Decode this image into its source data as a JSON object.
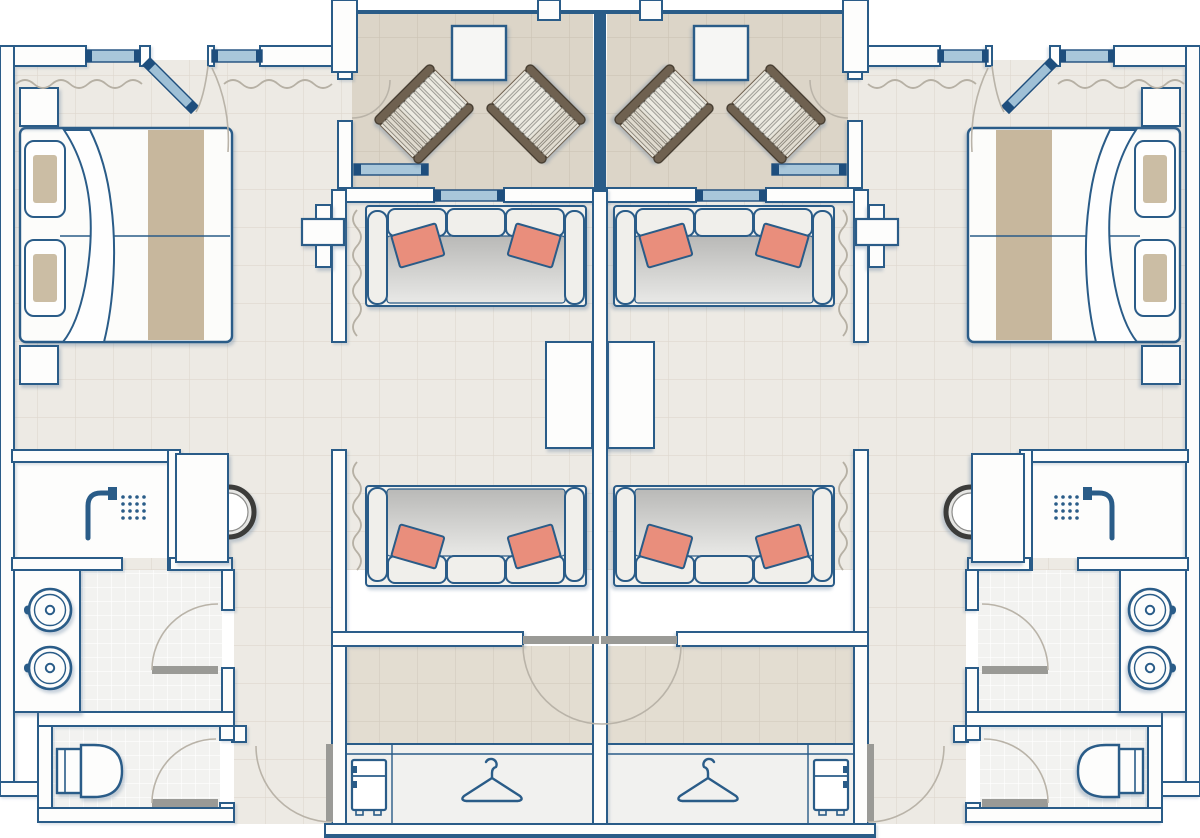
{
  "document": {
    "kind": "architectural-floor-plan",
    "title": "Twin hotel suites floor plan",
    "units": 2,
    "symmetry": "mirrored about vertical center axis",
    "visible_text": ""
  },
  "palette": {
    "wall_outline": "#2a5c88",
    "wall_fill": "#fdfdfc",
    "floor_main": "#edeae4",
    "floor_main_grid": "#ded8cf",
    "floor_balcony": "#dcd5c8",
    "floor_balcony_grid": "#ccc4b4",
    "floor_hall": "#e3ddd1",
    "floor_hall_grid": "#d3ccbe",
    "floor_tile": "#f2f2f0",
    "floor_tile_grid": "#ffffff",
    "glass": "#a9c7da",
    "glass_frame": "#1e4e7d",
    "accent_coral": "#e98e7c",
    "bed_runner": "#c7b79d",
    "pillow_inner": "#cbbda4",
    "seat_dark": "#b9b9b7",
    "seat_light": "#e9e9e7",
    "wood_dark": "#6f6150",
    "wood_edge": "#3e3529",
    "slat_light": "#edebe2",
    "slat_shade": "#e0dbcf",
    "door_leaf_gray": "#9a9a96",
    "swing_arc": "#b9b3a8",
    "railing": "#2a5c88",
    "shadow": "rgba(88,118,152,0.33)"
  },
  "rooms_per_unit": [
    {
      "name": "terrace",
      "features": [
        "deck-chair",
        "deck-chair",
        "patio-table",
        "railing",
        "sliding-door"
      ]
    },
    {
      "name": "bedroom",
      "features": [
        "double-bed",
        "pillow",
        "pillow",
        "nightstand",
        "nightstand",
        "tv",
        "windows",
        "curtain",
        "entry-door"
      ]
    },
    {
      "name": "living-room",
      "features": [
        "sofa",
        "sofa",
        "accent-cushions",
        "console-table",
        "desk",
        "desk-chair",
        "curtains",
        "balcony-slider"
      ]
    },
    {
      "name": "bathroom",
      "features": [
        "walk-in-shower",
        "vanity-counter",
        "sink",
        "sink",
        "faucets",
        "door"
      ]
    },
    {
      "name": "wc",
      "features": [
        "toilet",
        "door"
      ]
    },
    {
      "name": "entry-hall",
      "features": [
        "wardrobe",
        "clothes-hanger",
        "mini-fridge",
        "entry-door-pair"
      ]
    }
  ],
  "icon_legend": [
    "deck-chair-icon",
    "patio-table-icon",
    "double-bed-icon",
    "pillow-icon",
    "nightstand-icon",
    "tv-icon",
    "sofa-icon",
    "cushion-icon",
    "console-icon",
    "desk-icon",
    "desk-chair-icon",
    "shower-icon",
    "sink-icon",
    "faucet-icon",
    "toilet-icon",
    "hanger-icon",
    "fridge-icon",
    "window-icon",
    "sliding-door-icon",
    "door-swing-icon",
    "curtain-icon",
    "railing-icon"
  ],
  "counts": {
    "deck_chairs": 4,
    "sofas": 4,
    "beds": 2,
    "sinks": 4,
    "toilets": 2,
    "showers": 2,
    "wardrobes": 2,
    "fridges": 2
  }
}
